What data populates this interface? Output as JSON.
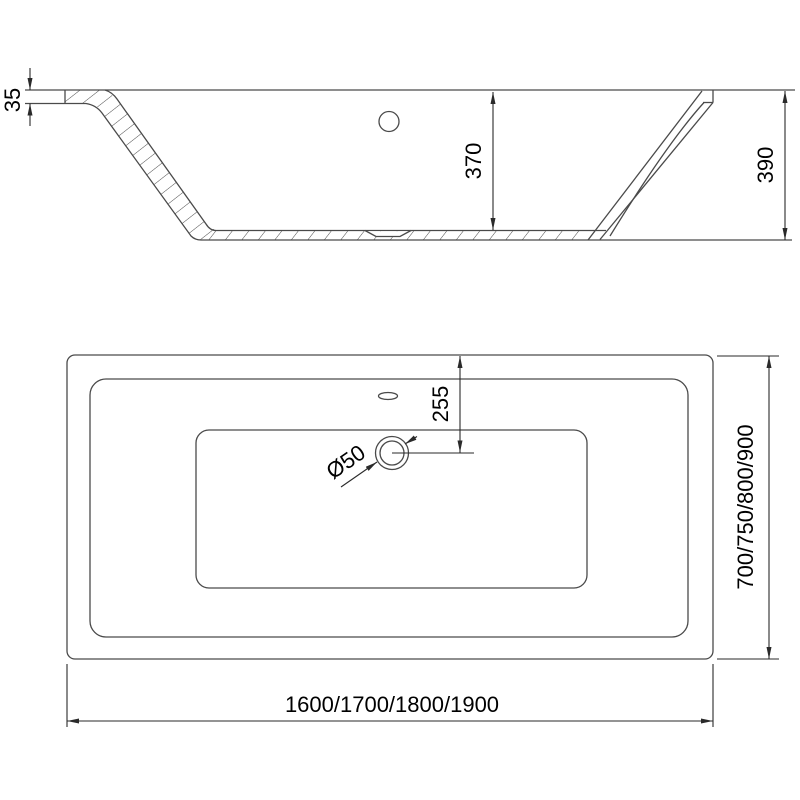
{
  "colors": {
    "background": "#ffffff",
    "geometry": "#4a4a4a",
    "dimension": "#2a2a2a",
    "text": "#000000"
  },
  "side_view": {
    "rim_thickness_label": "35",
    "inner_depth_label": "370",
    "overall_height_label": "390"
  },
  "plan_view": {
    "drain_offset_label": "255",
    "drain_diameter_label": "Ø50",
    "width_options_label": "700/750/800/900",
    "length_options_label": "1600/1700/1800/1900"
  }
}
